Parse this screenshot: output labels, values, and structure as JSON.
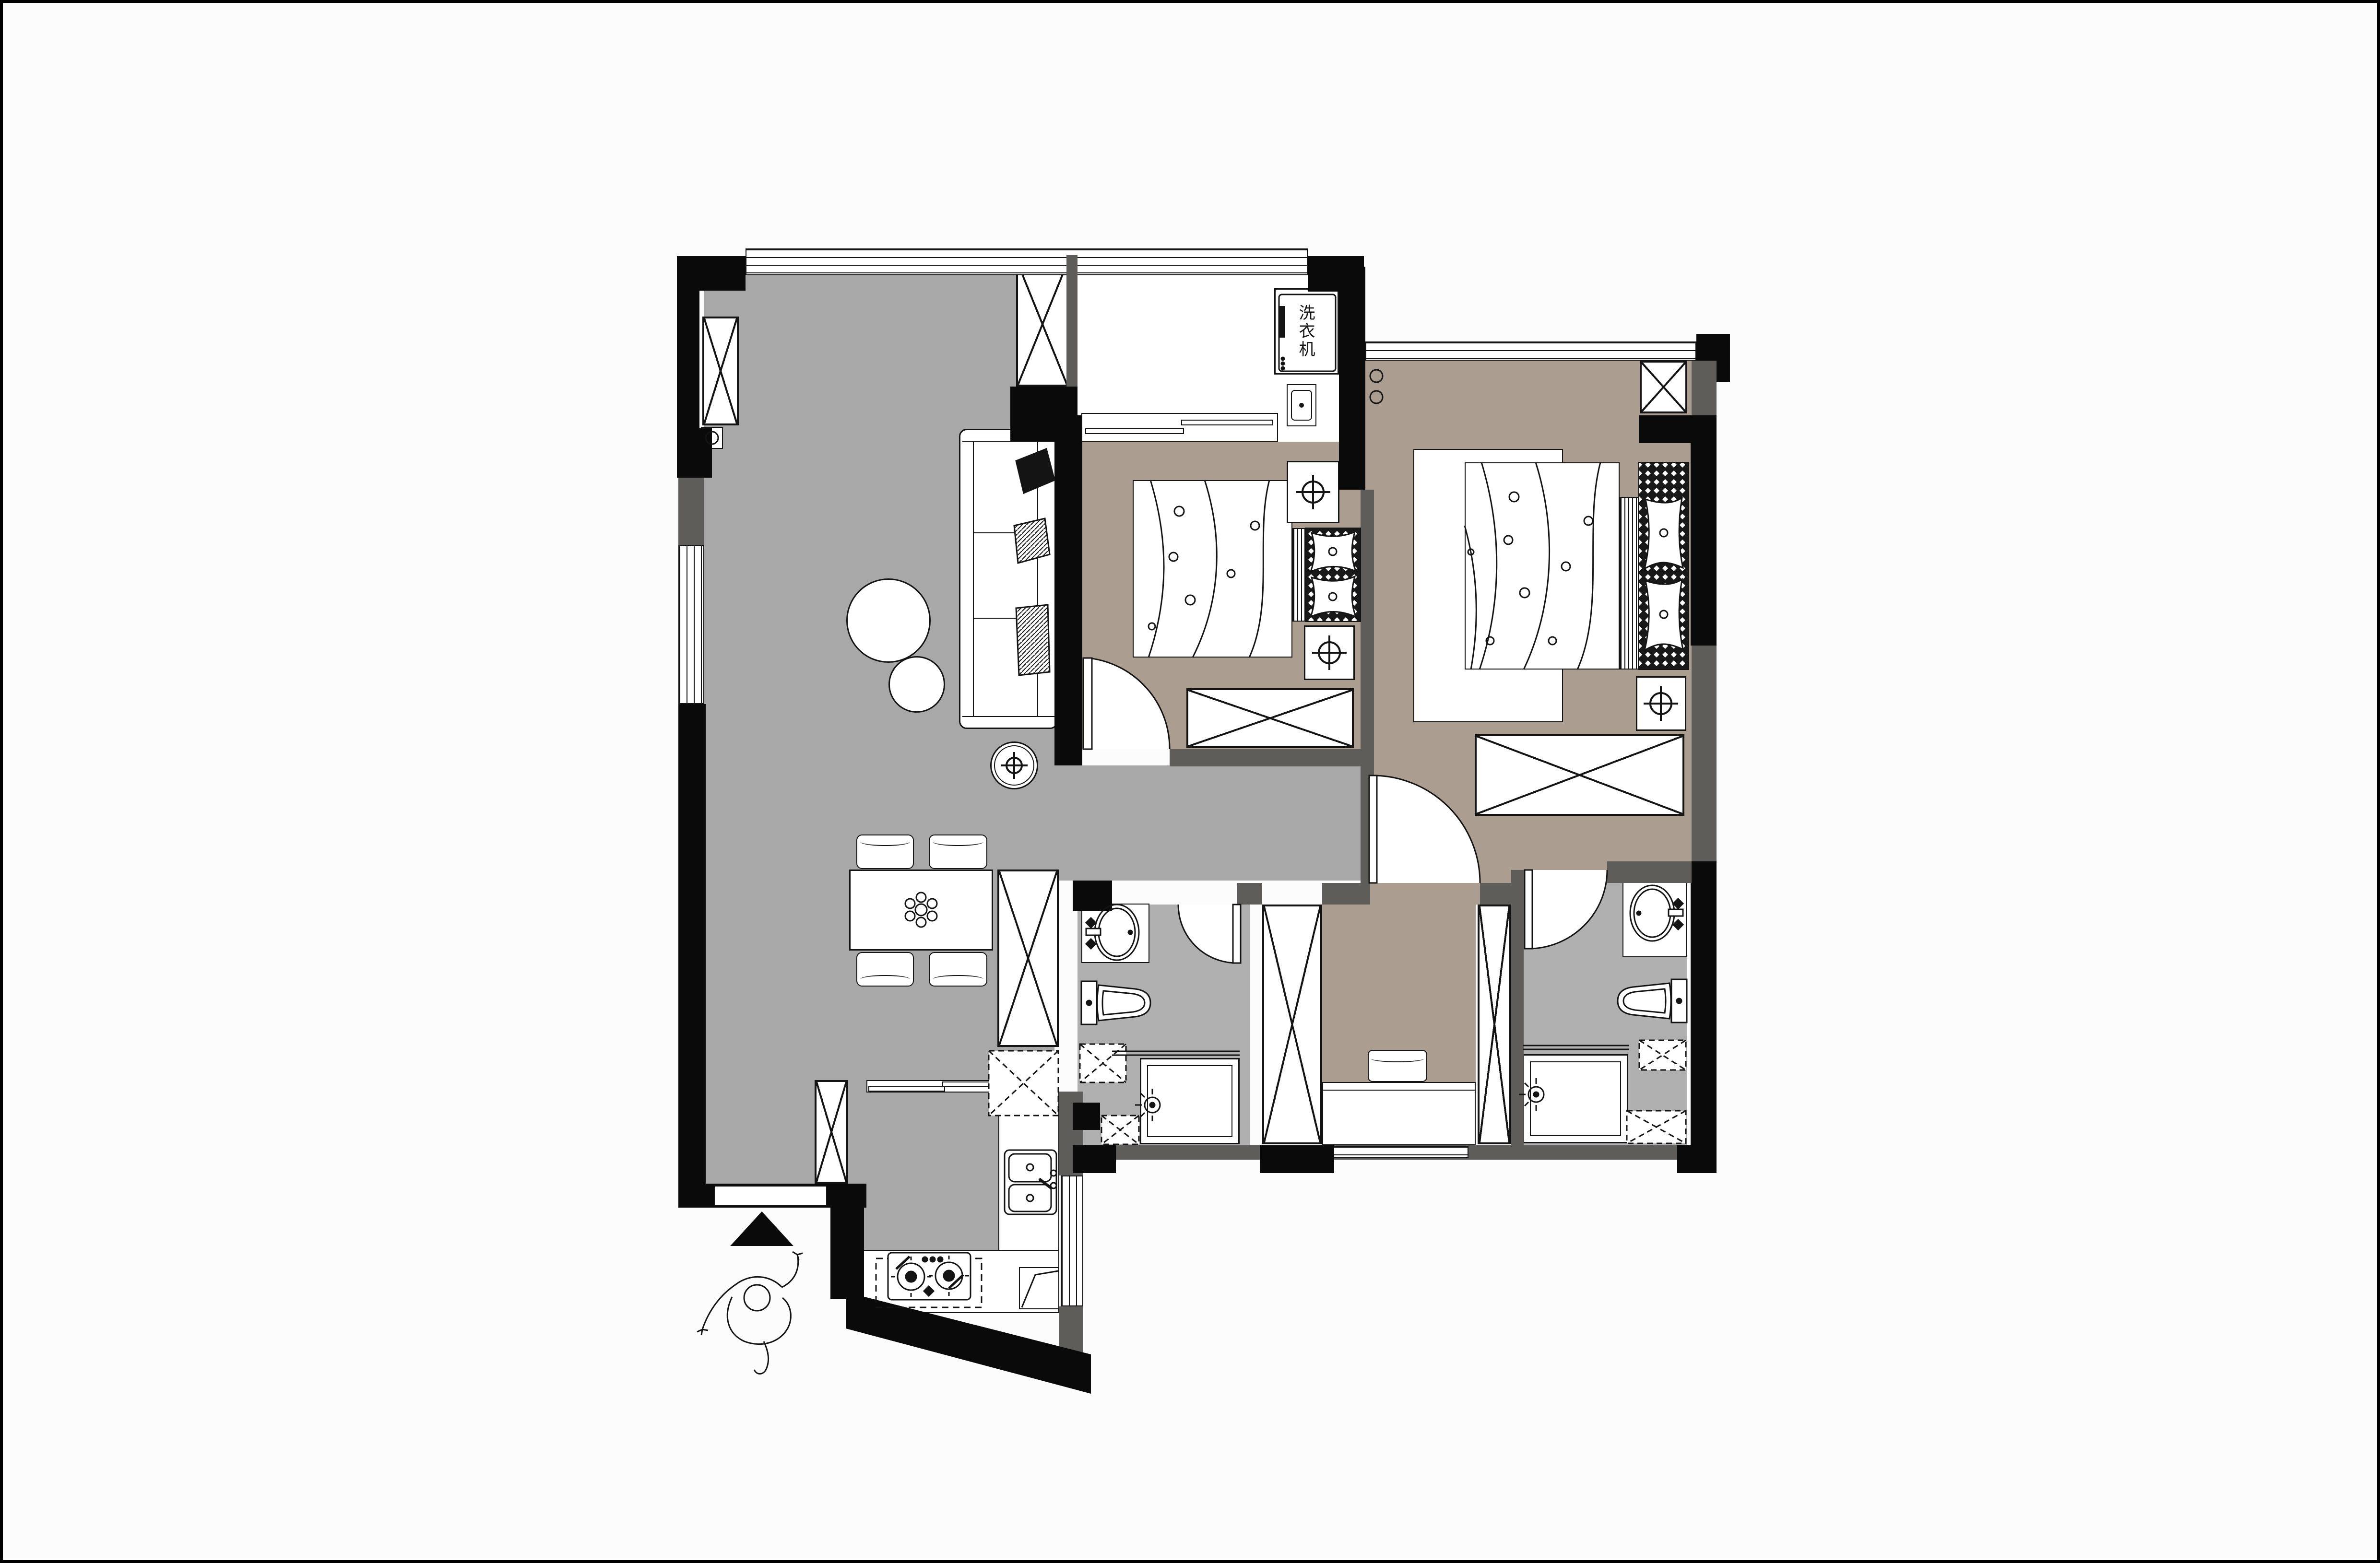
{
  "plan": {
    "labels": {
      "washing_machine": "洗衣机"
    },
    "colors": {
      "background": "#fcfcfc",
      "frame": "#000000",
      "floor_living_dining": "#a8a8a8",
      "floor_bedrooms_dressing": "#ab9e90",
      "floor_bathrooms": "#b0b0b0",
      "floor_balcony_kitchen_counters": "#ffffff",
      "wall_exterior": "#0a0a0a",
      "wall_interior": "#5f5d59",
      "linework": "#141414"
    },
    "rooms": {
      "living_dining": {
        "floor_color": "#a8a8a8"
      },
      "balcony_laundry": {
        "floor_color": "#ffffff"
      },
      "bedroom_small": {
        "floor_color": "#ab9e90"
      },
      "bedroom_master": {
        "floor_color": "#ab9e90"
      },
      "hallway": {
        "floor_color": "#a8a8a8"
      },
      "bathroom_left": {
        "floor_color": "#b0b0b0"
      },
      "bathroom_right": {
        "floor_color": "#b0b0b0"
      },
      "dressing_room": {
        "floor_color": "#ab9e90"
      },
      "kitchen": {
        "floor_color": "#a8a8a8"
      },
      "entry": {
        "floor_color": "#fcfcfc"
      }
    }
  }
}
